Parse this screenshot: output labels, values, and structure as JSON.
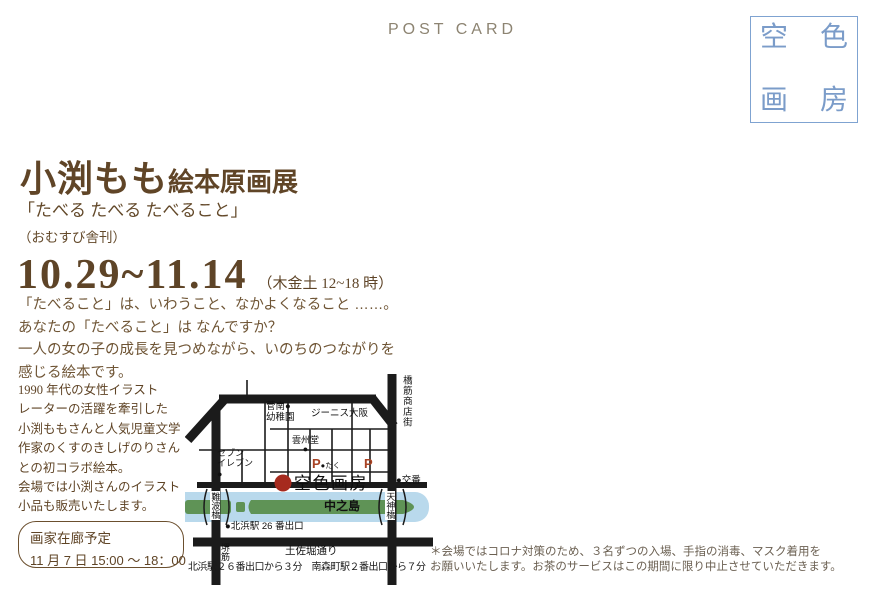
{
  "header": {
    "postcard_label": "POST CARD"
  },
  "logo_box": {
    "chars": [
      "空",
      "色",
      "画",
      "房"
    ],
    "border_color": "#7fa3d1",
    "text_color": "#7b9cc9"
  },
  "title": {
    "artist": "小渕もも",
    "suffix": "絵本原画展",
    "book": "「たべる たべる たべること」",
    "publisher": "（おむすび舎刊）"
  },
  "dates": {
    "range": "10.29~11.14",
    "hours": "（木金土 12~18 時）"
  },
  "lead": [
    "「たべること」は、いわうこと、なかよくなること ……。",
    "あなたの「たべること」は なんですか？",
    "一人の女の子の成長を見つめながら、いのちのつながりを",
    "感じる絵本です。"
  ],
  "description": [
    "1990 年代の女性イラスト",
    "レーターの活躍を牽引した",
    "小渕ももさんと人気児童文学",
    "作家のくすのきしげのりさん",
    "との初コラボ絵本。",
    "会場では小渕さんのイラスト",
    "小品も販売いたします。"
  ],
  "visit": {
    "title": "画家在廊予定",
    "schedule": "11 月 7 日 15:00 ～ 18：00"
  },
  "map": {
    "colors": {
      "road": "#1b1b1b",
      "river": "#b9d9ec",
      "island": "#5f9356",
      "marker": "#a62a1e",
      "parking": "#a84324"
    },
    "labels": {
      "kindergarten": "菅南●\n幼稚園",
      "zenith": "ジーニス大阪",
      "unshudo": "雲州堂\n●",
      "seven": "セブン\nイレブン\n●",
      "parking_left_p": "P",
      "parking_left_note": "●たく",
      "parking_right_p": "P",
      "gallery": "空色画房",
      "koban": "●交番",
      "shopping_street": "橋筋商店街",
      "nanbabashi": "難波橋",
      "tenjinbashi": "天神橋",
      "nakanoshima": "中之島",
      "kitahama_exit": "●北浜駅 26 番出口",
      "sakaisuji": "堺\n筋",
      "tosabori": "土佐堀通り",
      "caption": "北浜駅２６番出口から３分　南森町駅２番出口から７分"
    }
  },
  "notice": [
    "＊会場ではコロナ対策のため、３名ずつの入場、手指の消毒、マスク着用を",
    "お願いいたします。お茶のサービスはこの期間に限り中止させていただきます。"
  ]
}
